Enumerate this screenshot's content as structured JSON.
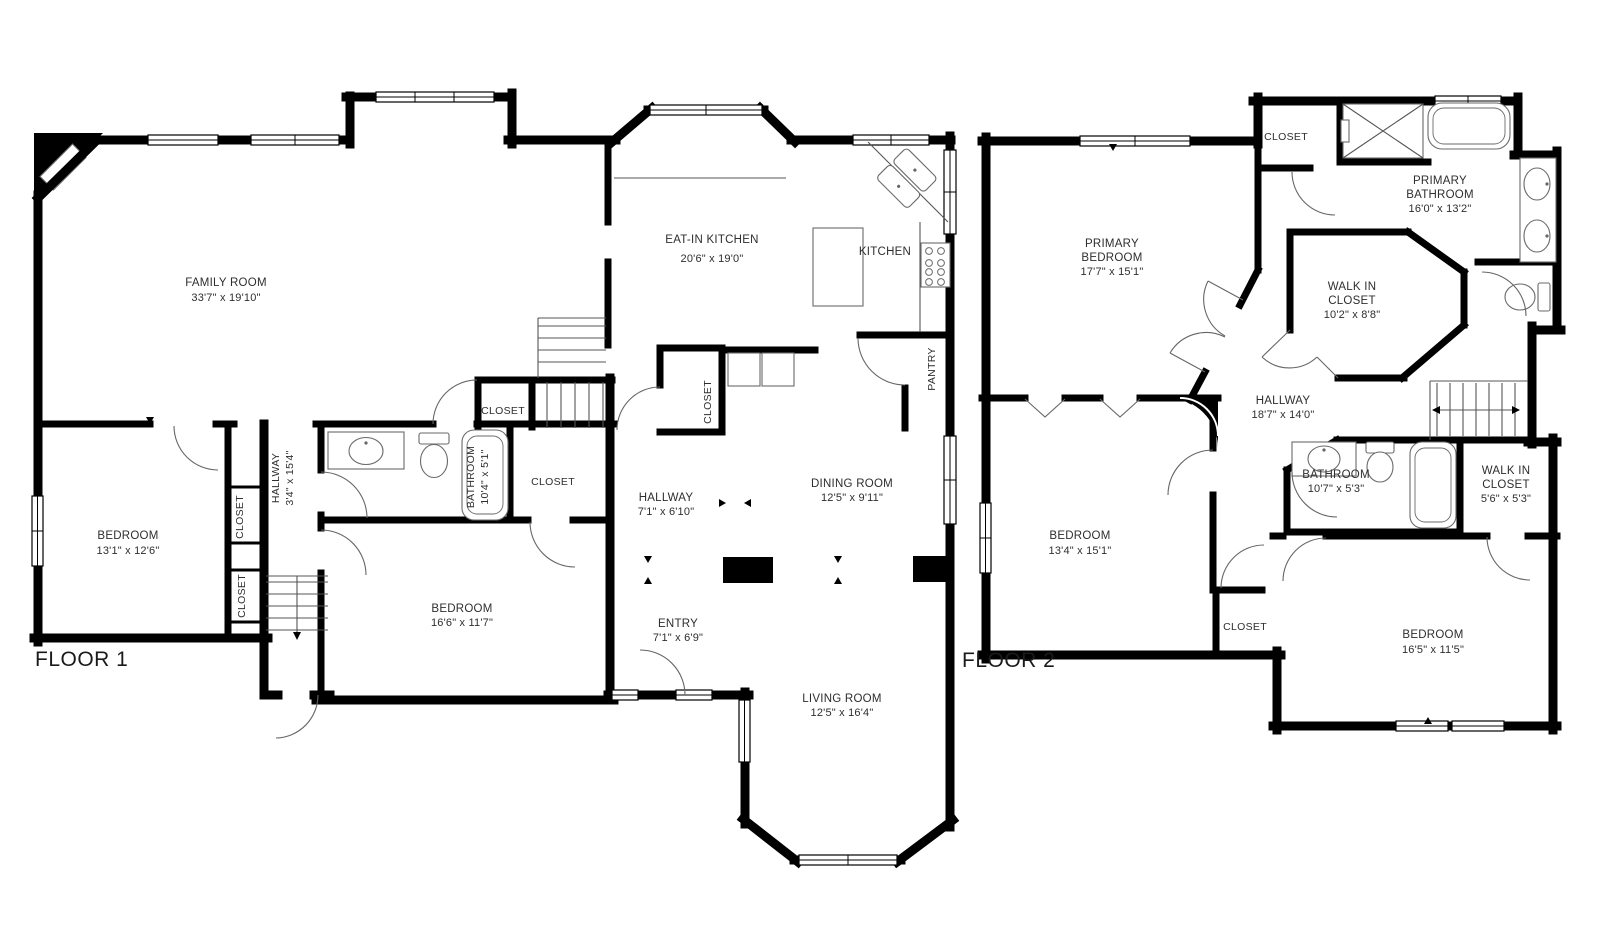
{
  "document": {
    "background": "#ffffff",
    "wall_color": "#000000",
    "line_color": "#555555",
    "text_color": "#2e2e2e"
  },
  "floor1": {
    "title": "FLOOR 1",
    "family_room": {
      "name": "FAMILY ROOM",
      "dims": "33'7\" x 19'10\""
    },
    "eat_in_kitchen": {
      "name": "EAT-IN KITCHEN",
      "dims": "20'6\" x 19'0\""
    },
    "kitchen": {
      "name": "KITCHEN"
    },
    "pantry": {
      "name": "PANTRY"
    },
    "closet_kitchen": {
      "name": "CLOSET"
    },
    "closet_stairs": {
      "name": "CLOSET"
    },
    "closet_bath": {
      "name": "CLOSET"
    },
    "closet_hall_upper": {
      "name": "CLOSET"
    },
    "closet_hall_lower": {
      "name": "CLOSET"
    },
    "bathroom": {
      "name": "BATHROOM",
      "dims": "10'4\" x 5'1\""
    },
    "hallway_side": {
      "name": "HALLWAY",
      "dims": "3'4\" x 15'4\""
    },
    "hallway": {
      "name": "HALLWAY",
      "dims": "7'1\" x 6'10\""
    },
    "entry": {
      "name": "ENTRY",
      "dims": "7'1\" x 6'9\""
    },
    "dining_room": {
      "name": "DINING ROOM",
      "dims": "12'5\" x 9'11\""
    },
    "living_room": {
      "name": "LIVING ROOM",
      "dims": "12'5\" x 16'4\""
    },
    "bedroom_left": {
      "name": "BEDROOM",
      "dims": "13'1\" x 12'6\""
    },
    "bedroom_center": {
      "name": "BEDROOM",
      "dims": "16'6\" x 11'7\""
    }
  },
  "floor2": {
    "title": "FLOOR 2",
    "primary_bedroom": {
      "line1": "PRIMARY",
      "line2": "BEDROOM",
      "dims": "17'7\" x 15'1\""
    },
    "primary_bathroom": {
      "line1": "PRIMARY",
      "line2": "BATHROOM",
      "dims": "16'0\" x 13'2\""
    },
    "walk_in_closet_primary": {
      "line1": "WALK IN",
      "line2": "CLOSET",
      "dims": "10'2\" x 8'8\""
    },
    "walk_in_closet": {
      "line1": "WALK IN",
      "line2": "CLOSET",
      "dims": "5'6\" x 5'3\""
    },
    "hallway": {
      "name": "HALLWAY",
      "dims": "18'7\" x 14'0\""
    },
    "bathroom": {
      "name": "BATHROOM",
      "dims": "10'7\" x 5'3\""
    },
    "bedroom_left": {
      "name": "BEDROOM",
      "dims": "13'4\" x 15'1\""
    },
    "bedroom_right": {
      "name": "BEDROOM",
      "dims": "16'5\" x 11'5\""
    },
    "closet_top": {
      "name": "CLOSET"
    },
    "closet_mid": {
      "name": "CLOSET"
    }
  }
}
